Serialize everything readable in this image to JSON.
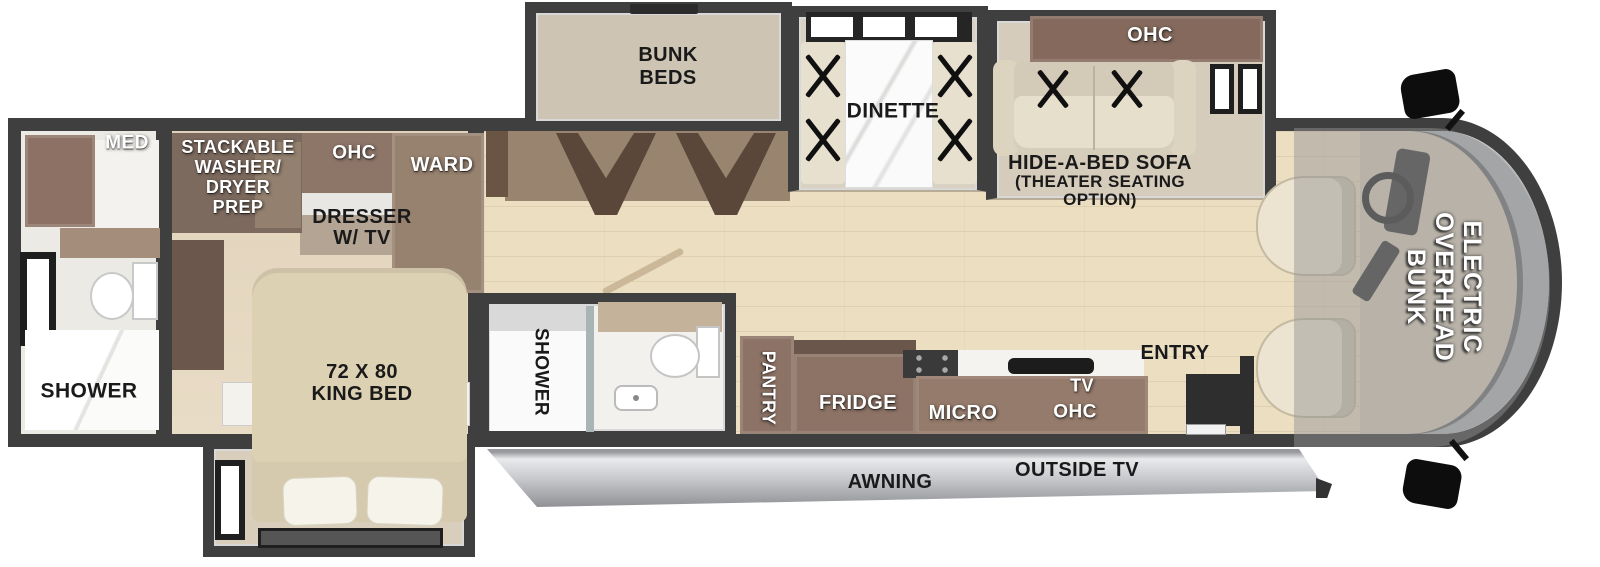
{
  "labels": {
    "med": "MED",
    "washer_l1": "STACKABLE",
    "washer_l2": "WASHER/",
    "washer_l3": "DRYER",
    "washer_l4": "PREP",
    "bedroom_ohc": "OHC",
    "ward": "WARD",
    "dresser_l1": "DRESSER",
    "dresser_l2": "W/ TV",
    "king_l1": "72 X 80",
    "king_l2": "KING BED",
    "rear_shower": "SHOWER",
    "bunk_l1": "BUNK",
    "bunk_l2": "BEDS",
    "dinette": "DINETTE",
    "sofa_ohc": "OHC",
    "sofa_l1": "HIDE-A-BED SOFA",
    "sofa_l2": "(THEATER SEATING",
    "sofa_l3": "OPTION)",
    "mid_shower": "SHOWER",
    "pantry": "PANTRY",
    "fridge": "FRIDGE",
    "micro": "MICRO",
    "tv": "TV",
    "kitchen_ohc": "OHC",
    "entry": "ENTRY",
    "overhead_l1": "ELECTRIC",
    "overhead_l2": "OVERHEAD",
    "overhead_l3": "BUNK",
    "awning": "AWNING",
    "outside_tv": "OUTSIDE TV"
  },
  "colors": {
    "wall": "#3f3f3f",
    "wood_floor": "#ebdec1",
    "carpet": "#e4d6bf",
    "cabinet_brown": "#8d7568",
    "cabinet_dark": "#6e594c",
    "bed_tan": "#ddd1b4",
    "slideout_interior": "#d6cdbd",
    "awning_gray": "#d2d4d8",
    "windshield_gray": "#b2b5b7",
    "label_white": "#ffffff",
    "label_black": "#1a1a1a"
  }
}
